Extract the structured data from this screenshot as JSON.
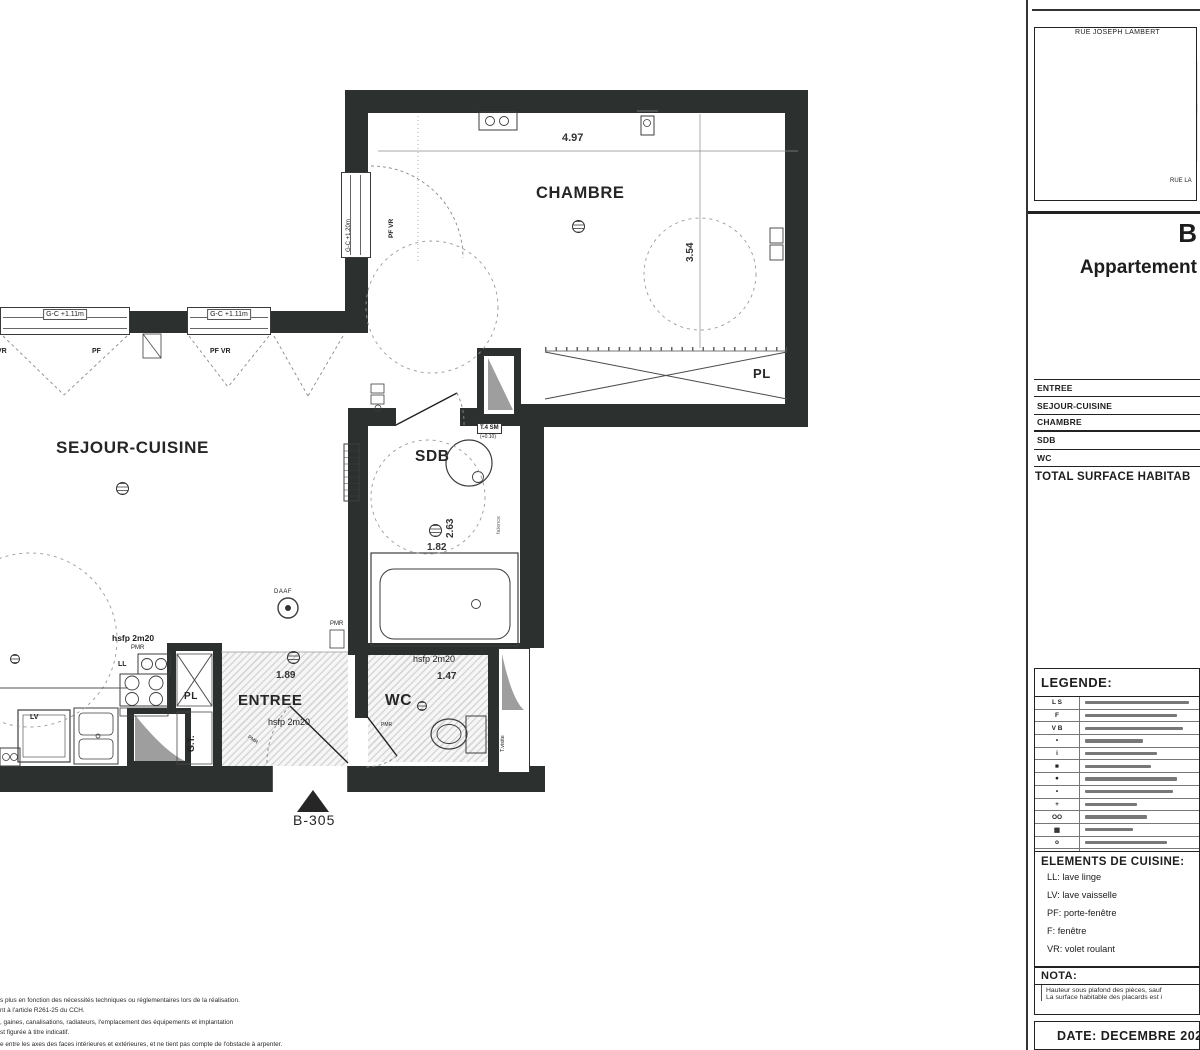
{
  "plan": {
    "rooms": {
      "chambre": "CHAMBRE",
      "sejour": "SEJOUR-CUISINE",
      "sdb": "SDB",
      "entree": "ENTREE",
      "wc": "WC",
      "pl_chambre": "PL",
      "pl_entree": "PL",
      "gt": "G.T.",
      "t_visite": "T.visite"
    },
    "dims": {
      "chambre_w": "4.97",
      "chambre_h": "3.54",
      "sdb_w": "1.82",
      "sdb_h": "2.63",
      "entree_w": "1.89",
      "wc_w": "1.47"
    },
    "annotations": {
      "hsfp": "hsfp 2m20",
      "pmr": "PMR",
      "daaf": "DAAF",
      "ll": "LL",
      "lv": "LV",
      "pf": "PF",
      "vr": "VR",
      "pf_vr": "PF VR",
      "gc_111": "G-C +1.11m",
      "gc_120": "G-C +1.20m",
      "t4sm": "T.4 SM",
      "t4sm_level": "(+0.10)",
      "faience": "faïence",
      "unit": "B-305"
    },
    "fine_print": [
      "s plus en fonction des nécessités techniques ou réglementaires lors de la réalisation.",
      "nt à l'article R261-25 du CCH.",
      ", gaines, canalisations, radiateurs, l'emplacement des équipements et implantation",
      "st figurée à titre indicatif.",
      "e entre les axes des faces intérieures et extérieures, et ne tient pas compte de l'obstacle à arpenter."
    ]
  },
  "sidebar": {
    "map": {
      "street_top": "RUE JOSEPH LAMBERT",
      "street_right": "RUE LA"
    },
    "title": {
      "building": "B",
      "line2": "Appartement"
    },
    "surface_table": {
      "rows": [
        "ENTREE",
        "SEJOUR-CUISINE",
        "CHAMBRE",
        "SDB",
        "WC"
      ],
      "total_label": "TOTAL SURFACE HABITAB"
    },
    "legend": {
      "title": "LEGENDE:",
      "symbols": [
        "L S",
        "F",
        "V B",
        "•",
        "i",
        "■",
        "●",
        "•",
        "+",
        "OO",
        "▦",
        "o",
        "O"
      ]
    },
    "cuisine": {
      "title": "ELEMENTS DE CUISINE:",
      "items": [
        "LL: lave linge",
        "LV: lave vaisselle",
        "PF: porte-fenêtre",
        "F: fenêtre",
        "VR: volet roulant"
      ]
    },
    "nota": {
      "title": "NOTA:",
      "lines": [
        "Hauteur sous plafond des pièces, sauf",
        "La surface habitable des placards est i"
      ]
    },
    "date": "DATE: DECEMBRE 2020"
  }
}
